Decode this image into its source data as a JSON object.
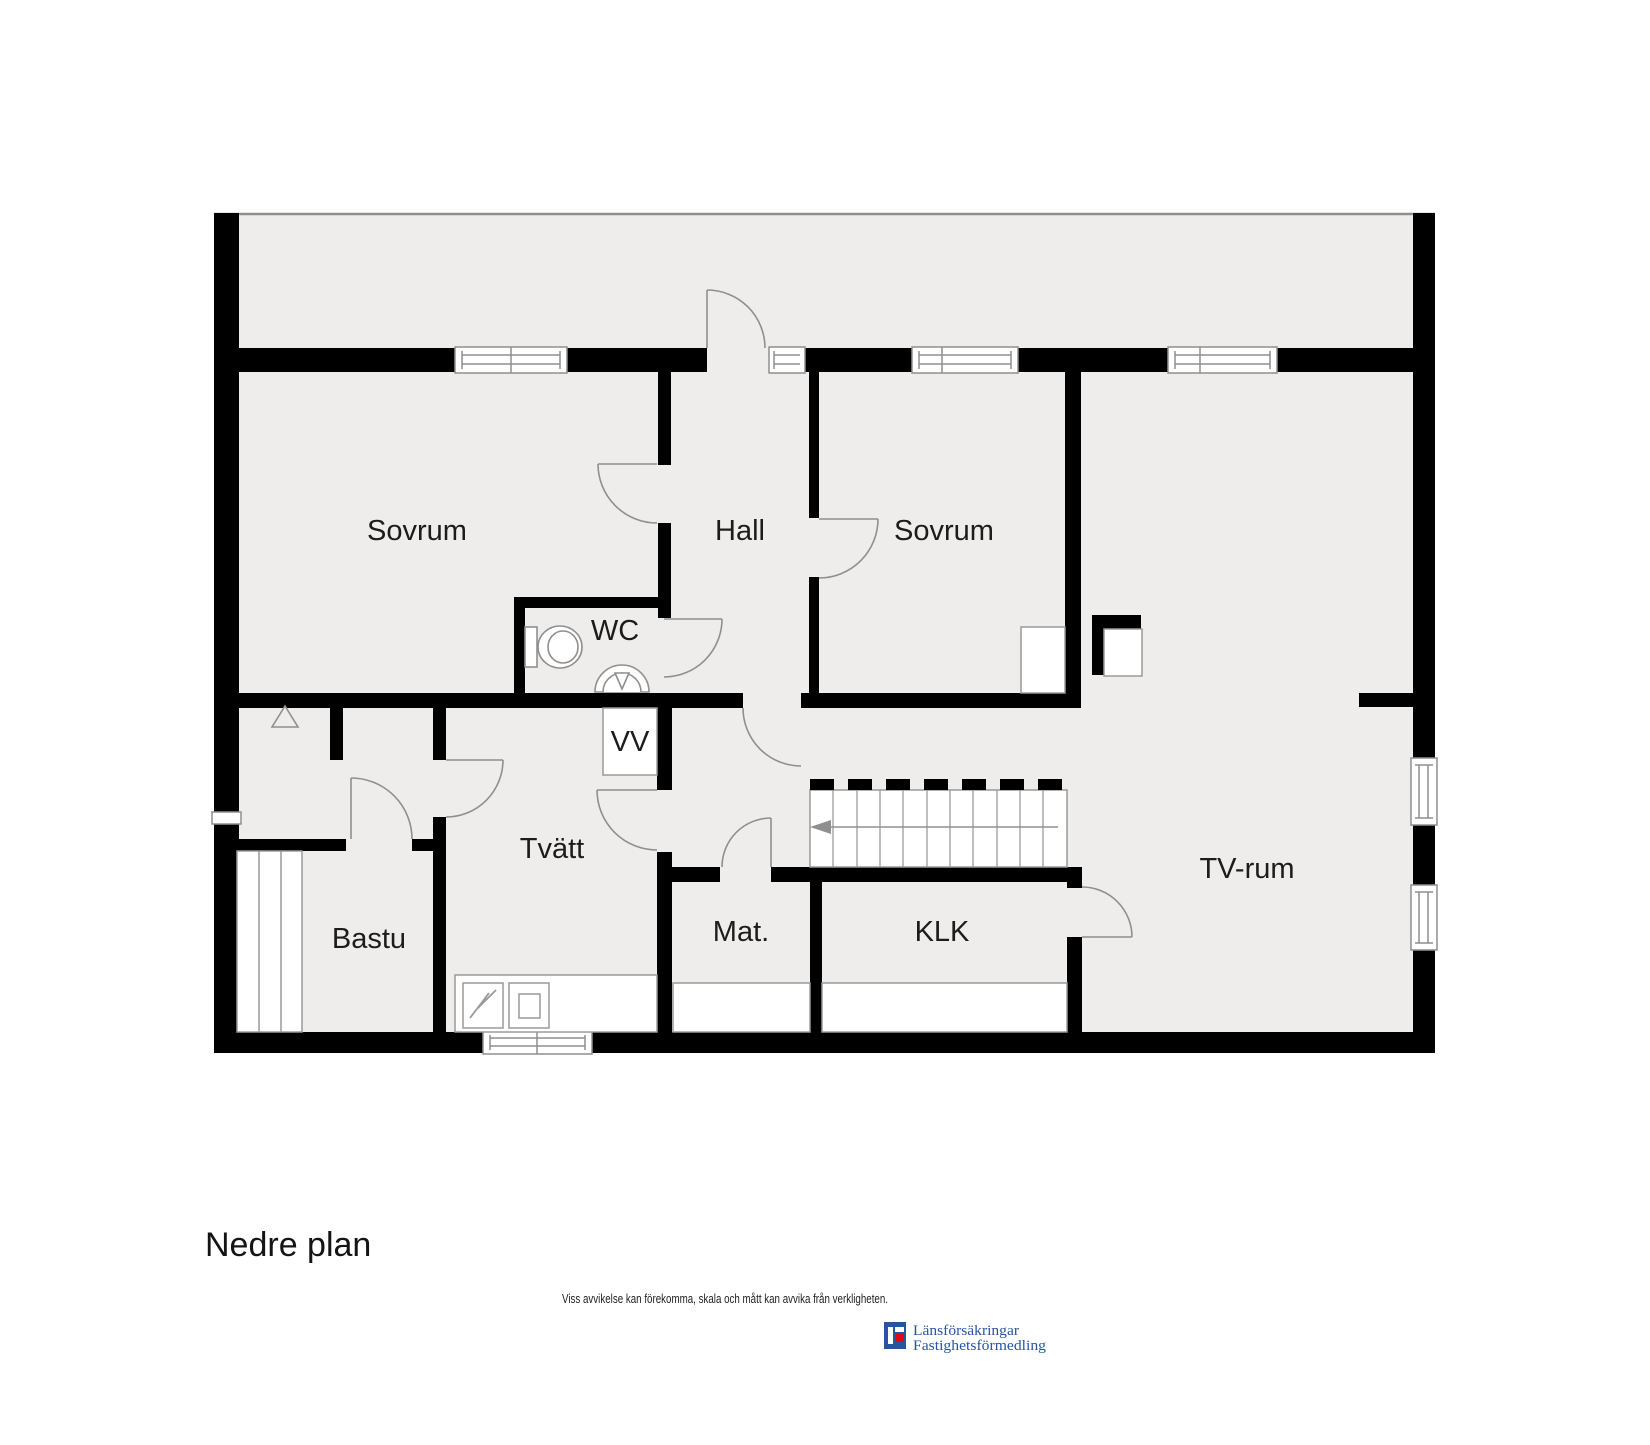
{
  "plan": {
    "title": "Nedre plan",
    "disclaimer": "Viss avvikelse kan förekomma, skala och mått kan avvika från verkligheten.",
    "colors": {
      "floor": "#efedec",
      "wall": "#000000",
      "thin_line": "#8f8f8f",
      "label": "#1c1c1c",
      "logo_blue": "#27549E",
      "logo_red": "#E30613"
    },
    "rooms": [
      {
        "label": "Sovrum",
        "cx": 417,
        "cy": 530
      },
      {
        "label": "Hall",
        "cx": 740,
        "cy": 530
      },
      {
        "label": "Sovrum",
        "cx": 944,
        "cy": 530
      },
      {
        "label": "WC",
        "cx": 615,
        "cy": 629
      },
      {
        "label": "VV",
        "cx": 630,
        "cy": 741
      },
      {
        "label": "Tvätt",
        "cx": 552,
        "cy": 848
      },
      {
        "label": "Bastu",
        "cx": 369,
        "cy": 938
      },
      {
        "label": "Mat.",
        "cx": 741,
        "cy": 931
      },
      {
        "label": "KLK",
        "cx": 942,
        "cy": 931
      },
      {
        "label": "TV-rum",
        "cx": 1247,
        "cy": 868
      }
    ],
    "logo": {
      "line1": "Länsförsäkringar",
      "line2": "Fastighetsförmedling"
    }
  }
}
